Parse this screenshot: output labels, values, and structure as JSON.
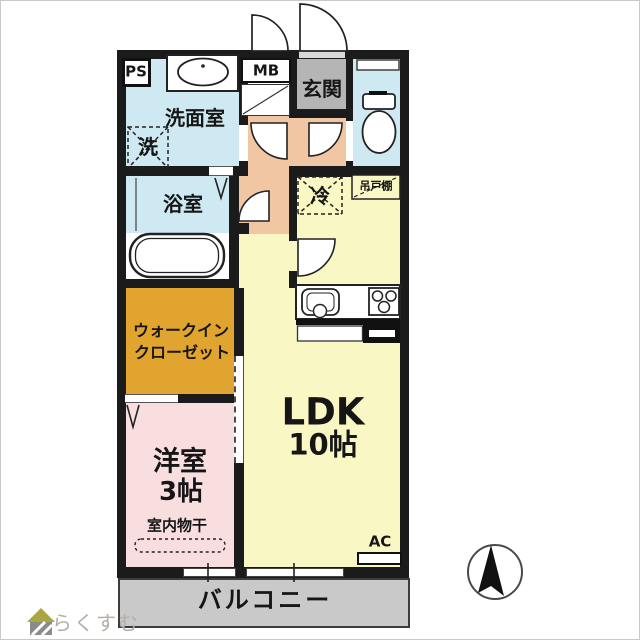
{
  "plan": {
    "title": "1LDK apartment floor plan",
    "rooms": {
      "ps": "PS",
      "mb": "MB",
      "genkan": "玄関",
      "washroom": "洗面室",
      "washer": "洗",
      "bathroom": "浴室",
      "wic_line1": "ウォークイン",
      "wic_line2": "クローゼット",
      "bedroom": "洋室",
      "bedroom_size": "3帖",
      "indoor_drying": "室内物干",
      "ldk": "LDK",
      "ldk_size": "10帖",
      "fridge": "冷",
      "hanging_cupboard": "吊戸棚",
      "ac": "AC",
      "balcony": "バルコニー"
    },
    "colors": {
      "wall": "#1b1b1b",
      "wet_area_blue": "#cfe9f2",
      "hallway_peach": "#f1c7a3",
      "genkan_gray": "#b5b5b5",
      "ldk_yellow": "#f9f7c3",
      "wic_orange": "#e1a42f",
      "bedroom_pink": "#f8dede",
      "balcony_gray": "#c9c9c9"
    }
  },
  "branding": {
    "logo": "らくすむ"
  }
}
